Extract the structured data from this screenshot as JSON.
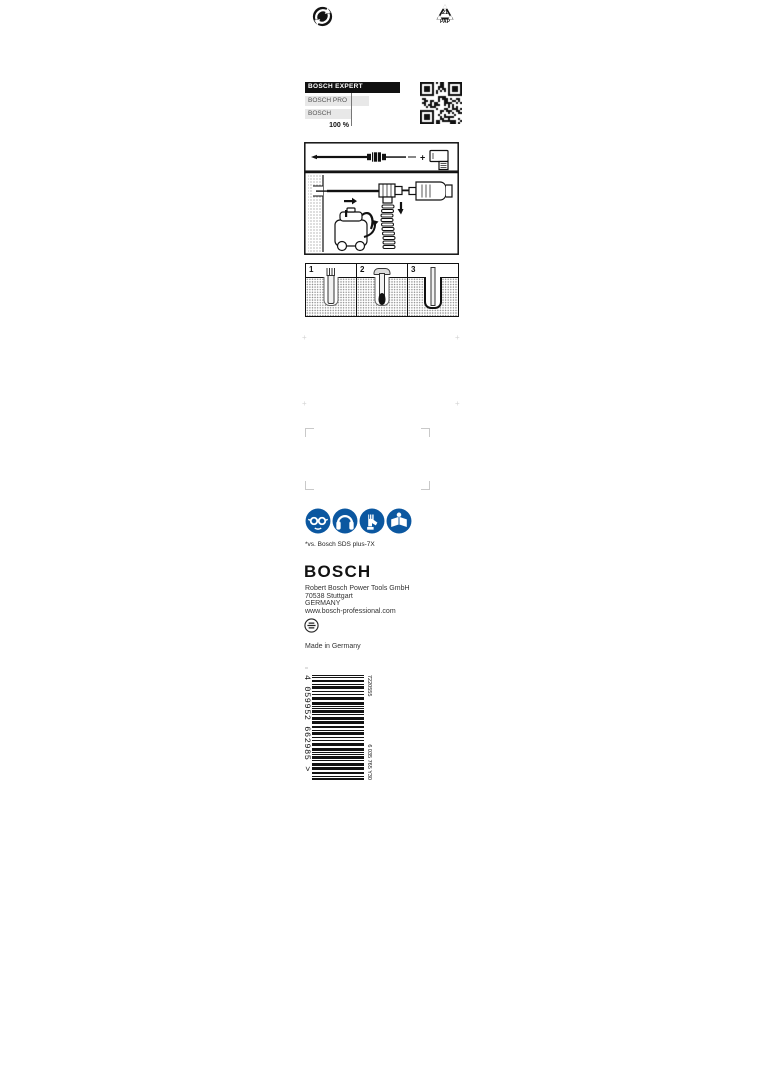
{
  "icons": {
    "green_dot": "green-dot-recycling",
    "pap_number": "21",
    "pap_label": "PAP",
    "safety": [
      "wear-eye-protection",
      "wear-ear-protection",
      "wear-gloves",
      "read-instructions"
    ],
    "safety_color": "#0b57a0"
  },
  "chart_data": {
    "type": "bar",
    "orientation": "horizontal",
    "categories": [
      "BOSCH EXPERT",
      "BOSCH PRO",
      "BOSCH"
    ],
    "values": [
      207,
      139,
      100
    ],
    "reference_value": 100,
    "reference_label": "100 %",
    "bar_colors": [
      "#111111",
      "#e8e8e8",
      "#e8e8e8"
    ],
    "legend": "off",
    "grid": "off"
  },
  "steps": {
    "labels": [
      "1",
      "2",
      "3"
    ]
  },
  "footnote": "*vs. Bosch SDS plus-7X",
  "brand": {
    "logo": "BOSCH",
    "logo_color": "#121212"
  },
  "address": {
    "lines": [
      "Robert Bosch Power Tools GmbH",
      "70538 Stuttgart",
      "GERMANY",
      "www.bosch-professional.com"
    ]
  },
  "made_in": "Made in Germany",
  "barcode": {
    "ean": "4059952662985",
    "ean_display": "4 059952 662985 >",
    "top_code": "7220555",
    "side_code": "6 035 765 Y30"
  }
}
